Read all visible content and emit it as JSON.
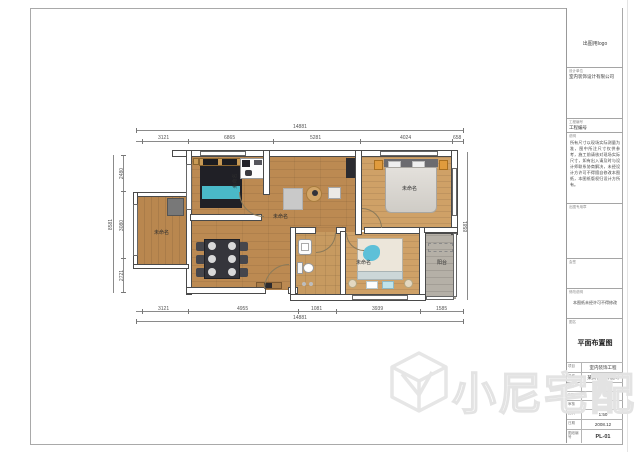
{
  "watermark": {
    "text": "小尼宅配",
    "logo": "cube-logo"
  },
  "title_block": {
    "logo_text": "出图用logo",
    "company": {
      "label": "设计单位",
      "value": "室内装饰设计有限公司"
    },
    "project_no": {
      "label": "工程编号",
      "value": "工程编号"
    },
    "notes": {
      "label": "说明",
      "body": "所有尺寸以现场实际测量为准，图中所注尺寸仅供参考，施工前请核对现场实际尺寸，如有出入请及时与设计师联系协商解决，未经设计方许可不得擅自修改本图纸，本图纸版权归设计方所有。"
    },
    "stamp": {
      "label": "出图专用章"
    },
    "countersign": {
      "label": "会签"
    },
    "revision": {
      "label": "修改说明",
      "value": "本图纸未经许可不得修改"
    },
    "drawing_name": {
      "label": "图名",
      "value": "平面布置图"
    },
    "info_table": [
      {
        "label": "项目",
        "value": "室内装饰工程"
      },
      {
        "label": "名称",
        "value": "某某花园样板间"
      },
      {
        "label": "设计",
        "value": ""
      },
      {
        "label": "制图",
        "value": ""
      },
      {
        "label": "审核",
        "value": ""
      },
      {
        "label": "比例",
        "value": "1:50"
      },
      {
        "label": "日期",
        "value": "2008.12"
      },
      {
        "label": "图纸编号",
        "value": "PL-01"
      }
    ]
  },
  "plan": {
    "room_labels": {
      "living": "未命名",
      "left_room": "未命名",
      "bedroom_left": "未命名",
      "bedroom_right": "未命名",
      "bedroom_bottom": "未命名",
      "balcony": "阳台"
    },
    "dimensions": {
      "top": {
        "overall": "14881",
        "segments": [
          "3121",
          "6865",
          "5281",
          "4024",
          "658"
        ]
      },
      "bottom": {
        "overall": "14881",
        "segments": [
          "3121",
          "4955",
          "1081",
          "3939",
          "1585"
        ]
      },
      "left": {
        "overall": "8581",
        "segments": [
          "2480",
          "3080",
          "2721"
        ]
      },
      "right": {
        "overall": "8581"
      }
    },
    "colors": {
      "wood_floor": "#bc8a52",
      "light_wood_floor": "#cfa167",
      "balcony_floor": "#b5b0a7",
      "wall_outline": "#4a4a4a",
      "accent_teal": "#4ab9c8",
      "accent_orange": "#e09b3d"
    }
  }
}
